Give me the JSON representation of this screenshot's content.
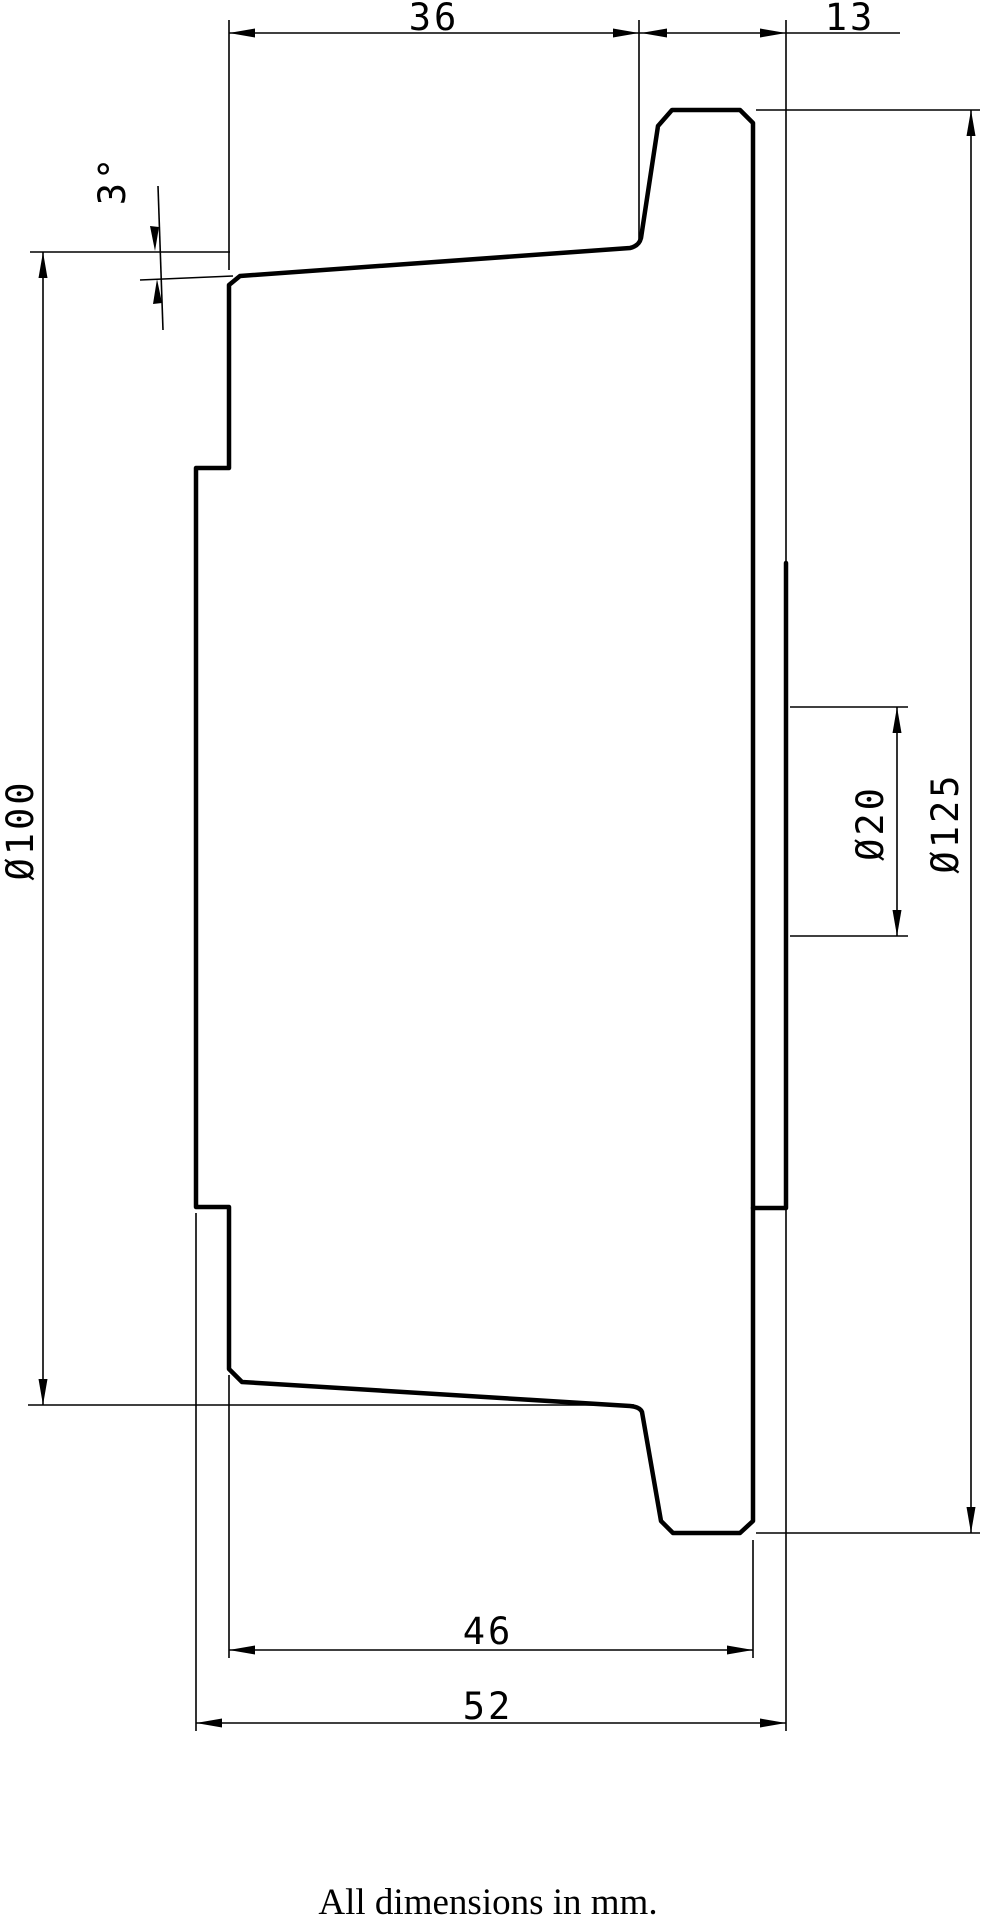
{
  "drawing": {
    "labels": {
      "top_width": "36",
      "flange_offset": "13",
      "draft_angle": "3°",
      "tread_diameter": "Ø100",
      "bore_diameter": "Ø20",
      "flange_diameter": "Ø125",
      "body_width": "46",
      "overall_width": "52"
    },
    "note": "All dimensions in mm.",
    "colors": {
      "line": "#000000",
      "background": "#ffffff"
    }
  }
}
